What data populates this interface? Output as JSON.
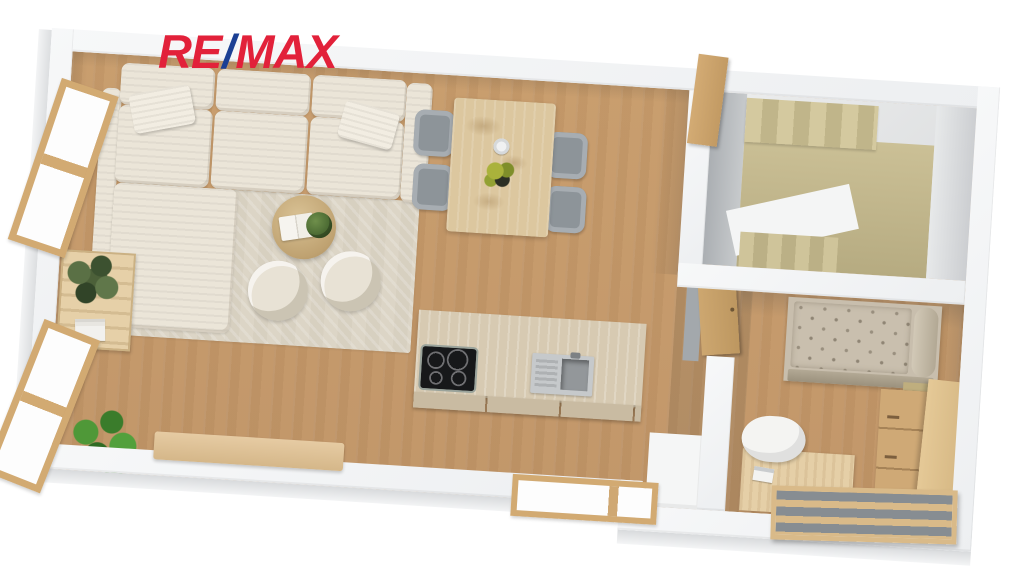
{
  "logo": {
    "re": "RE",
    "slash": "/",
    "max": "MAX",
    "red": "#e2213a",
    "blue": "#1b3f94"
  },
  "plan": {
    "style": "3d-top-down-floor-plan-render",
    "rotation_deg": 3.6,
    "palette": {
      "wall": "#f3f4f5",
      "floor_oak": "#c79c6c",
      "stairs_tan": "#c5ba90",
      "sofa_cream": "#ebe5d8",
      "rug_beige": "#dcd5c6",
      "bed_taupe": "#c8bead",
      "wood_furniture": "#d9b88c",
      "dining_chair_gray": "#9ba1a7",
      "cooktop_black": "#17181a",
      "sink_steel": "#c6c9cb",
      "plant_green": "#4a8a33"
    },
    "rooms": [
      {
        "name": "open living / dining / kitchen",
        "floor": "oak planks"
      },
      {
        "name": "stairwell",
        "floor": "tan stairs"
      },
      {
        "name": "bedroom / study",
        "floor": "oak planks"
      }
    ],
    "furniture": [
      {
        "name": "corner sofa with 2 pillows",
        "room": "living"
      },
      {
        "name": "herringbone rug",
        "room": "living"
      },
      {
        "name": "round coffee table with open book and plant",
        "room": "living"
      },
      {
        "name": "swivel armchair",
        "room": "living",
        "count": 2
      },
      {
        "name": "side table with plant and magazines",
        "room": "living"
      },
      {
        "name": "potted floor plant",
        "room": "living"
      },
      {
        "name": "rustic dining table with cup and flowers",
        "room": "dining"
      },
      {
        "name": "gray dining chair",
        "room": "dining",
        "count": 4
      },
      {
        "name": "kitchen island with induction cooktop and steel sink",
        "room": "kitchen"
      },
      {
        "name": "wood sideboard bench",
        "room": "living"
      },
      {
        "name": "white cabinet",
        "room": "kitchen"
      },
      {
        "name": "U-shaped staircase",
        "room": "stairwell"
      },
      {
        "name": "tufted daybed with bolster",
        "room": "bedroom"
      },
      {
        "name": "nightstand with paper",
        "room": "bedroom"
      },
      {
        "name": "dresser and wardrobe",
        "room": "bedroom"
      },
      {
        "name": "desk with laptop",
        "room": "bedroom"
      },
      {
        "name": "white desk chair",
        "room": "bedroom"
      },
      {
        "name": "slatted storage bench",
        "room": "bedroom"
      }
    ],
    "openings": [
      {
        "type": "window",
        "wall": "left",
        "count": 2
      },
      {
        "type": "window",
        "wall": "bottom",
        "count": 1
      },
      {
        "type": "door",
        "location": "stair entry"
      },
      {
        "type": "door",
        "location": "bedroom entry"
      }
    ]
  }
}
